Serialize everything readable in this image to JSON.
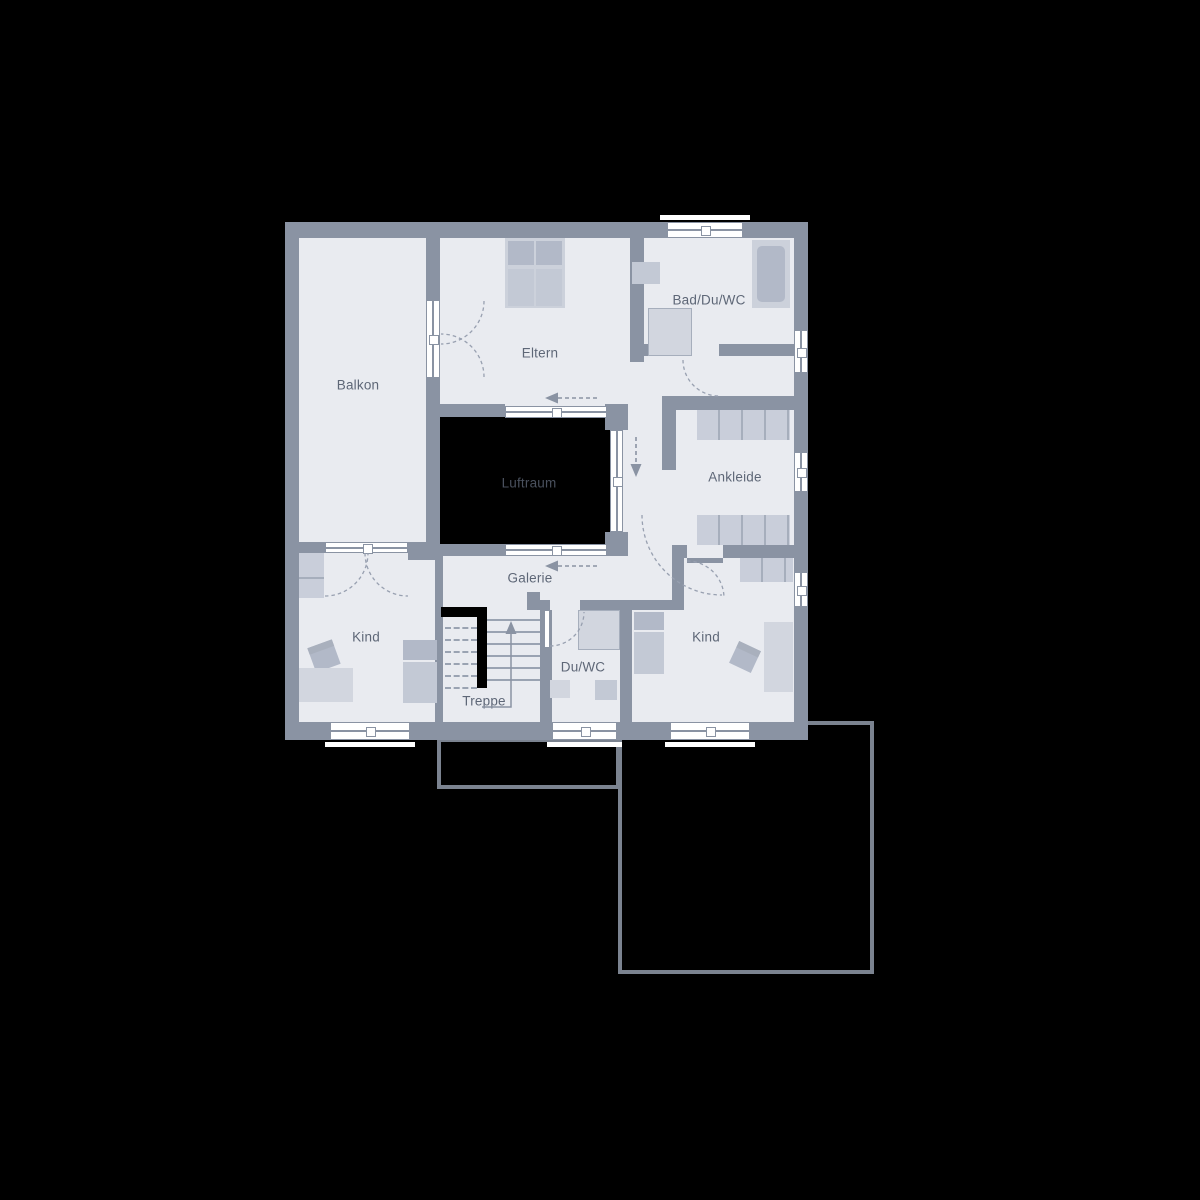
{
  "plan_title": "Obergeschoss Grundriss",
  "rooms": {
    "balkon": {
      "label": "Balkon"
    },
    "eltern": {
      "label": "Eltern"
    },
    "bad": {
      "label": "Bad/Du/WC"
    },
    "luftraum": {
      "label": "Luftraum"
    },
    "ankleide": {
      "label": "Ankleide"
    },
    "galerie": {
      "label": "Galerie"
    },
    "kind_left": {
      "label": "Kind"
    },
    "kind_right": {
      "label": "Kind"
    },
    "du_wc": {
      "label": "Du/WC"
    },
    "treppe": {
      "label": "Treppe"
    }
  },
  "colors": {
    "bg": "#000000",
    "wall": "#8a93a3",
    "floor": "#e9ebf0",
    "void": "#000000",
    "fur-light": "#d2d6df",
    "fur-mid": "#c3c9d5",
    "fur-dark": "#b2b9c8",
    "fur-base": "#ccd1db",
    "closet": "#c9ceda",
    "divider": "#a6aebc",
    "stair-line": "#9aa3b2",
    "label": "#5e6777",
    "label-dark": "#4a515e",
    "outline": "#7b8390",
    "white": "#ffffff"
  }
}
